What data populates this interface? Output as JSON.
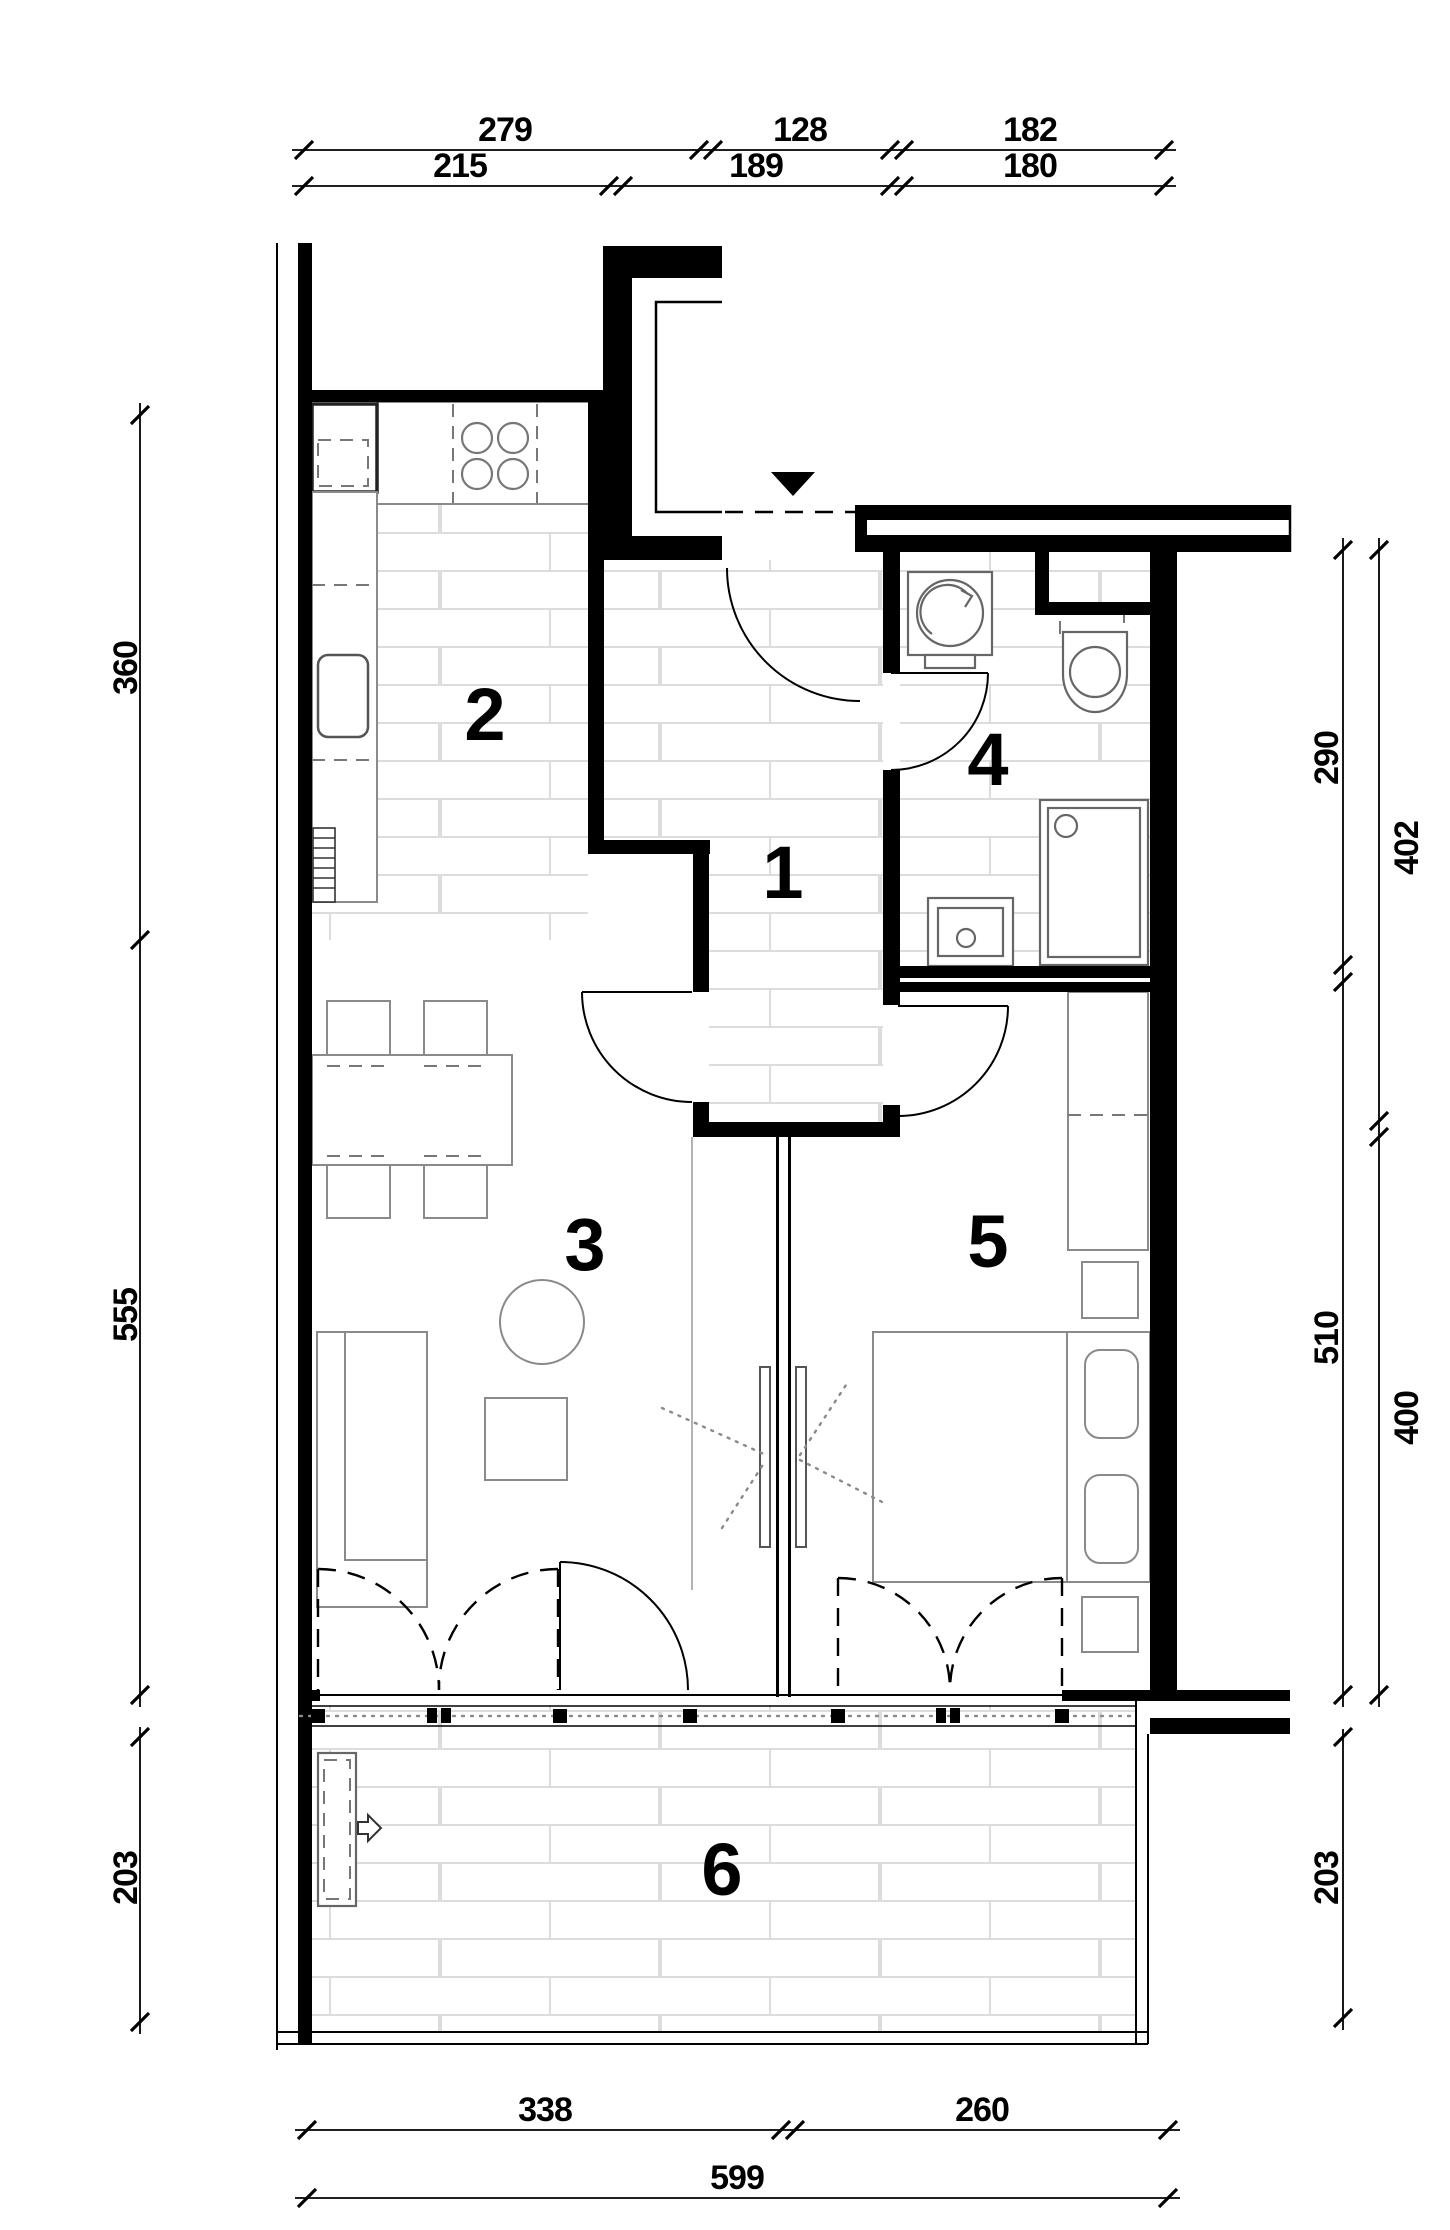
{
  "title": "apartment-floor-plan",
  "rooms": [
    "1",
    "2",
    "3",
    "4",
    "5",
    "6"
  ],
  "dims": {
    "top_row1": [
      "279",
      "128",
      "182"
    ],
    "top_row2": [
      "215",
      "189",
      "180"
    ],
    "left": [
      "360",
      "555",
      "203"
    ],
    "right_inner": [
      "290",
      "510",
      "203"
    ],
    "right_outer": [
      "402",
      "400"
    ],
    "bottom_row1": [
      "338",
      "260"
    ],
    "bottom_row2": [
      "599"
    ]
  },
  "colors": {
    "wall": "#000000",
    "tile_line": "#dcdcdc",
    "furniture": "#8a8a8a",
    "paper": "#ffffff"
  }
}
